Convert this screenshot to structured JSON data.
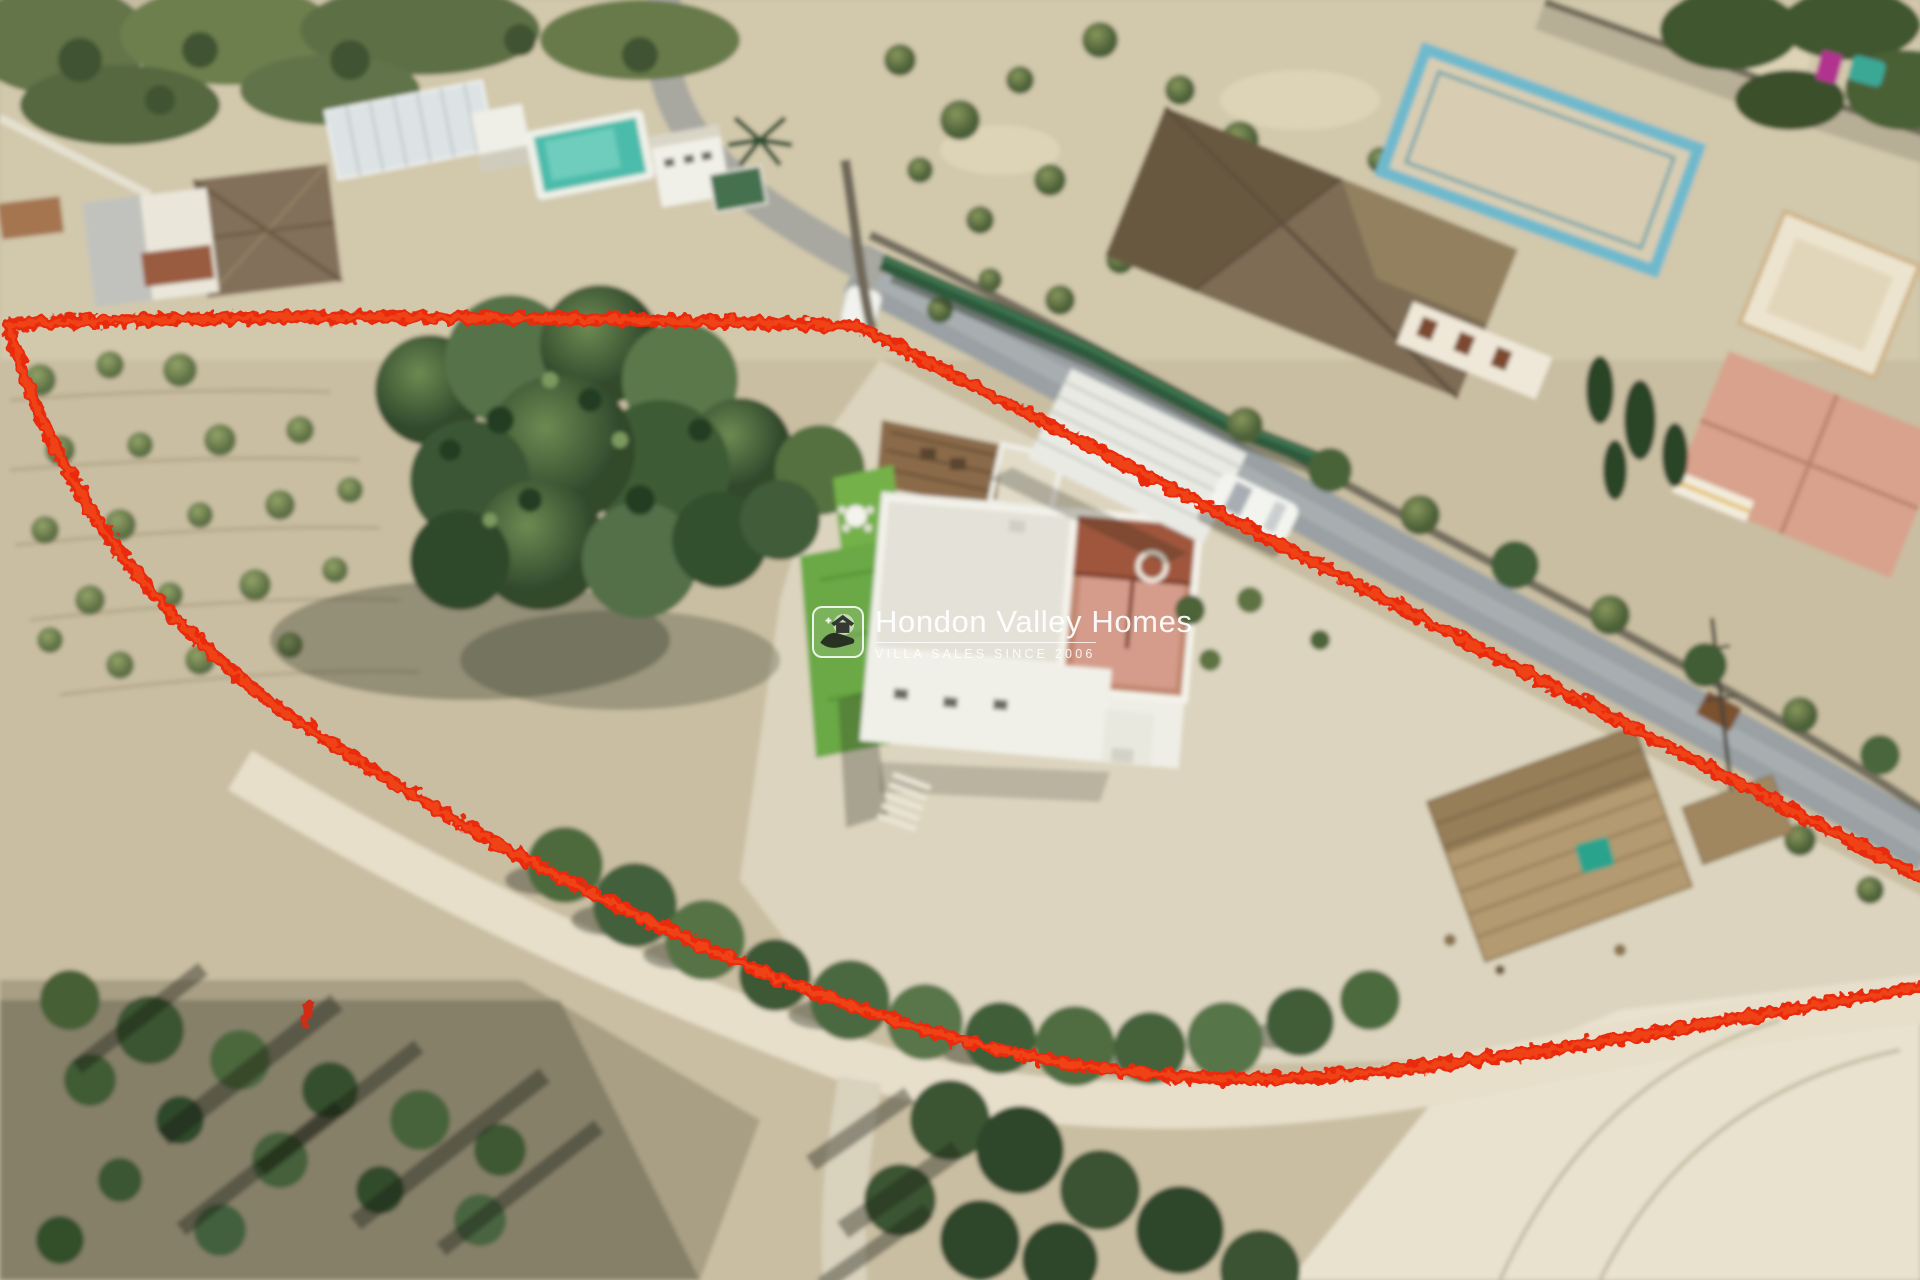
{
  "watermark": {
    "logo_icon": "hand-holding-house-icon",
    "title": "Hondon Valley Homes",
    "tagline": "VILLA SALES SINCE 2006"
  },
  "annotation": {
    "boundary_color": "#e92a0d",
    "boundary_style": "hand-drawn outline of plot",
    "small_marker_color": "#cf2e18"
  }
}
